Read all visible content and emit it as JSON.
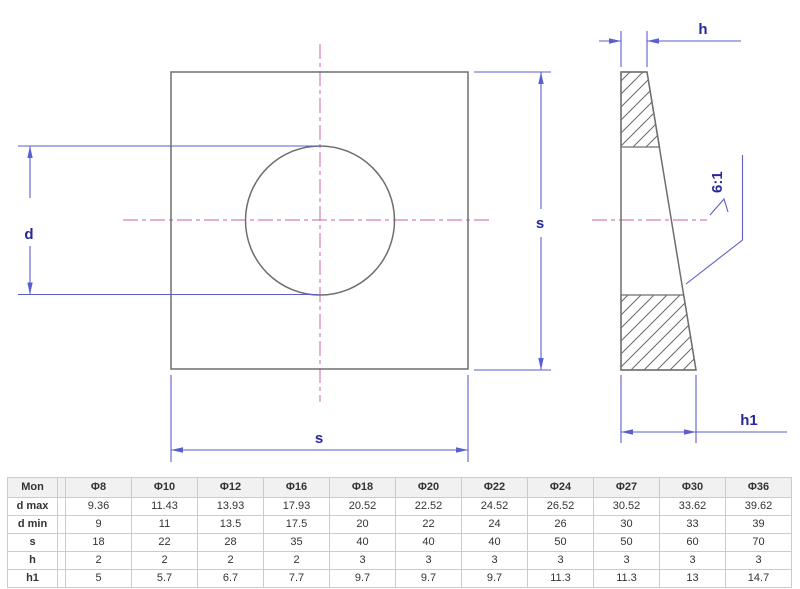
{
  "drawing": {
    "labels": {
      "d": "d",
      "s_right": "s",
      "s_bottom": "s",
      "h": "h",
      "h1": "h1",
      "taper": "6:1"
    },
    "colors": {
      "outline_gray": "#6e6e6e",
      "dimension_blue": "#5a5fce",
      "dimension_text_navy": "#28289a",
      "centerline_pink": "#d67fb8"
    }
  },
  "table": {
    "header": [
      "Mon",
      "Φ8",
      "Φ10",
      "Φ12",
      "Φ16",
      "Φ18",
      "Φ20",
      "Φ22",
      "Φ24",
      "Φ27",
      "Φ30",
      "Φ36"
    ],
    "rows": [
      {
        "label": "d max",
        "values": [
          "9.36",
          "11.43",
          "13.93",
          "17.93",
          "20.52",
          "22.52",
          "24.52",
          "26.52",
          "30.52",
          "33.62",
          "39.62"
        ]
      },
      {
        "label": "d min",
        "values": [
          "9",
          "11",
          "13.5",
          "17.5",
          "20",
          "22",
          "24",
          "26",
          "30",
          "33",
          "39"
        ]
      },
      {
        "label": "s",
        "values": [
          "18",
          "22",
          "28",
          "35",
          "40",
          "40",
          "40",
          "50",
          "50",
          "60",
          "70"
        ]
      },
      {
        "label": "h",
        "values": [
          "2",
          "2",
          "2",
          "2",
          "3",
          "3",
          "3",
          "3",
          "3",
          "3",
          "3"
        ]
      },
      {
        "label": "h1",
        "values": [
          "5",
          "5.7",
          "6.7",
          "7.7",
          "9.7",
          "9.7",
          "9.7",
          "11.3",
          "11.3",
          "13",
          "14.7"
        ]
      }
    ]
  }
}
